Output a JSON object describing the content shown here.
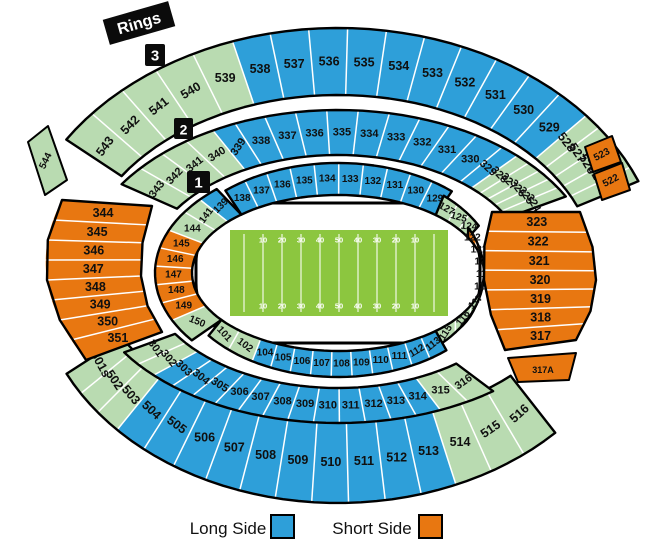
{
  "colors": {
    "long_side": "#2E9FD9",
    "short_side": "#E87711",
    "neutral": "#B9DBB1",
    "field_green": "#8CC63F"
  },
  "legend": {
    "long": {
      "label": "Long Side"
    },
    "short": {
      "label": "Short Side"
    }
  },
  "ring_markers": {
    "rings_label": "Rings",
    "ring_3": "3",
    "ring_2": "2",
    "ring_1": "1"
  },
  "field": {
    "yard_numbers": [
      "10",
      "20",
      "30",
      "40",
      "50",
      "40",
      "30",
      "20",
      "10"
    ]
  },
  "sections": {
    "upper_top": [
      {
        "label": "543",
        "side": "neutral"
      },
      {
        "label": "542",
        "side": "neutral"
      },
      {
        "label": "541",
        "side": "neutral"
      },
      {
        "label": "540",
        "side": "neutral"
      },
      {
        "label": "539",
        "side": "neutral"
      },
      {
        "label": "538",
        "side": "long"
      },
      {
        "label": "537",
        "side": "long"
      },
      {
        "label": "536",
        "side": "long"
      },
      {
        "label": "535",
        "side": "long"
      },
      {
        "label": "534",
        "side": "long"
      },
      {
        "label": "533",
        "side": "long"
      },
      {
        "label": "532",
        "side": "long"
      },
      {
        "label": "531",
        "side": "long"
      },
      {
        "label": "530",
        "side": "long"
      },
      {
        "label": "529",
        "side": "long"
      },
      {
        "label": "528",
        "side": "neutral"
      },
      {
        "label": "527",
        "side": "neutral"
      },
      {
        "label": "526",
        "side": "neutral"
      },
      {
        "label": "525",
        "side": "neutral"
      },
      {
        "label": "524",
        "side": "neutral"
      }
    ],
    "upper_left_sliver": [
      {
        "label": "544",
        "side": "neutral"
      }
    ],
    "upper_right_slivers": [
      {
        "label": "523",
        "side": "short"
      },
      {
        "label": "522",
        "side": "short"
      }
    ],
    "upper_bottom": [
      {
        "label": "516",
        "side": "neutral"
      },
      {
        "label": "515",
        "side": "neutral"
      },
      {
        "label": "514",
        "side": "neutral"
      },
      {
        "label": "513",
        "side": "long"
      },
      {
        "label": "512",
        "side": "long"
      },
      {
        "label": "511",
        "side": "long"
      },
      {
        "label": "510",
        "side": "long"
      },
      {
        "label": "509",
        "side": "long"
      },
      {
        "label": "508",
        "side": "long"
      },
      {
        "label": "507",
        "side": "long"
      },
      {
        "label": "506",
        "side": "long"
      },
      {
        "label": "505",
        "side": "long"
      },
      {
        "label": "504",
        "side": "long"
      },
      {
        "label": "503",
        "side": "neutral"
      },
      {
        "label": "502",
        "side": "neutral"
      },
      {
        "label": "501s",
        "side": "neutral"
      }
    ],
    "mid_top": [
      {
        "label": "343",
        "side": "neutral"
      },
      {
        "label": "342",
        "side": "neutral"
      },
      {
        "label": "341",
        "side": "neutral"
      },
      {
        "label": "340",
        "side": "neutral"
      },
      {
        "label": "339",
        "side": "long"
      },
      {
        "label": "338",
        "side": "long"
      },
      {
        "label": "337",
        "side": "long"
      },
      {
        "label": "336",
        "side": "long"
      },
      {
        "label": "335",
        "side": "long"
      },
      {
        "label": "334",
        "side": "long"
      },
      {
        "label": "333",
        "side": "long"
      },
      {
        "label": "332",
        "side": "long"
      },
      {
        "label": "331",
        "side": "long"
      },
      {
        "label": "330",
        "side": "long"
      },
      {
        "label": "329",
        "side": "long"
      },
      {
        "label": "328",
        "side": "neutral"
      },
      {
        "label": "327",
        "side": "neutral"
      },
      {
        "label": "326",
        "side": "neutral"
      },
      {
        "label": "325",
        "side": "neutral"
      },
      {
        "label": "324",
        "side": "neutral"
      }
    ],
    "mid_bottom": [
      {
        "label": "316",
        "side": "neutral"
      },
      {
        "label": "315",
        "side": "neutral"
      },
      {
        "label": "314",
        "side": "long"
      },
      {
        "label": "313",
        "side": "long"
      },
      {
        "label": "312",
        "side": "long"
      },
      {
        "label": "311",
        "side": "long"
      },
      {
        "label": "310",
        "side": "long"
      },
      {
        "label": "309",
        "side": "long"
      },
      {
        "label": "308",
        "side": "long"
      },
      {
        "label": "307",
        "side": "long"
      },
      {
        "label": "306",
        "side": "long"
      },
      {
        "label": "305",
        "side": "long"
      },
      {
        "label": "304",
        "side": "long"
      },
      {
        "label": "303",
        "side": "long"
      },
      {
        "label": "302",
        "side": "neutral"
      },
      {
        "label": "301",
        "side": "neutral"
      }
    ],
    "west_block": [
      {
        "label": "344",
        "side": "short"
      },
      {
        "label": "345",
        "side": "short"
      },
      {
        "label": "346",
        "side": "short"
      },
      {
        "label": "347",
        "side": "short"
      },
      {
        "label": "348",
        "side": "short"
      },
      {
        "label": "349",
        "side": "short"
      },
      {
        "label": "350",
        "side": "short"
      },
      {
        "label": "351",
        "side": "short"
      }
    ],
    "east_block": [
      {
        "label": "323",
        "side": "short"
      },
      {
        "label": "322",
        "side": "short"
      },
      {
        "label": "321",
        "side": "short"
      },
      {
        "label": "320",
        "side": "short"
      },
      {
        "label": "319",
        "side": "short"
      },
      {
        "label": "318",
        "side": "short"
      },
      {
        "label": "317",
        "side": "short"
      }
    ],
    "east_block_annex": [
      {
        "label": "317A",
        "side": "short"
      }
    ],
    "lower_top": [
      {
        "label": "138",
        "side": "long"
      },
      {
        "label": "137",
        "side": "long"
      },
      {
        "label": "136",
        "side": "long"
      },
      {
        "label": "135",
        "side": "long"
      },
      {
        "label": "134",
        "side": "long"
      },
      {
        "label": "133",
        "side": "long"
      },
      {
        "label": "132",
        "side": "long"
      },
      {
        "label": "131",
        "side": "long"
      },
      {
        "label": "130",
        "side": "long"
      },
      {
        "label": "129",
        "side": "long"
      }
    ],
    "lower_top_right": [
      {
        "label": "127",
        "side": "neutral"
      },
      {
        "label": "125",
        "side": "neutral"
      },
      {
        "label": "124",
        "side": "neutral"
      }
    ],
    "lower_right": [
      {
        "label": "122",
        "side": "short"
      },
      {
        "label": "121",
        "side": "short"
      },
      {
        "label": "120",
        "side": "short"
      },
      {
        "label": "119",
        "side": "short"
      },
      {
        "label": "118",
        "side": "short"
      },
      {
        "label": "117",
        "side": "neutral"
      },
      {
        "label": "116",
        "side": "neutral"
      },
      {
        "label": "115",
        "side": "neutral"
      }
    ],
    "lower_bottom": [
      {
        "label": "113",
        "side": "long"
      },
      {
        "label": "112",
        "side": "long"
      },
      {
        "label": "111",
        "side": "long"
      },
      {
        "label": "110",
        "side": "long"
      },
      {
        "label": "109",
        "side": "long"
      },
      {
        "label": "108",
        "side": "long"
      },
      {
        "label": "107",
        "side": "long"
      },
      {
        "label": "106",
        "side": "long"
      },
      {
        "label": "105",
        "side": "long"
      },
      {
        "label": "104",
        "side": "long"
      },
      {
        "label": "102",
        "side": "neutral"
      },
      {
        "label": "101",
        "side": "neutral"
      }
    ],
    "lower_left": [
      {
        "label": "150",
        "side": "neutral"
      },
      {
        "label": "149",
        "side": "short"
      },
      {
        "label": "148",
        "side": "short"
      },
      {
        "label": "147",
        "side": "short"
      },
      {
        "label": "146",
        "side": "short"
      },
      {
        "label": "145",
        "side": "short"
      },
      {
        "label": "144",
        "side": "neutral"
      },
      {
        "label": "141",
        "side": "neutral"
      },
      {
        "label": "139",
        "side": "long"
      }
    ]
  }
}
